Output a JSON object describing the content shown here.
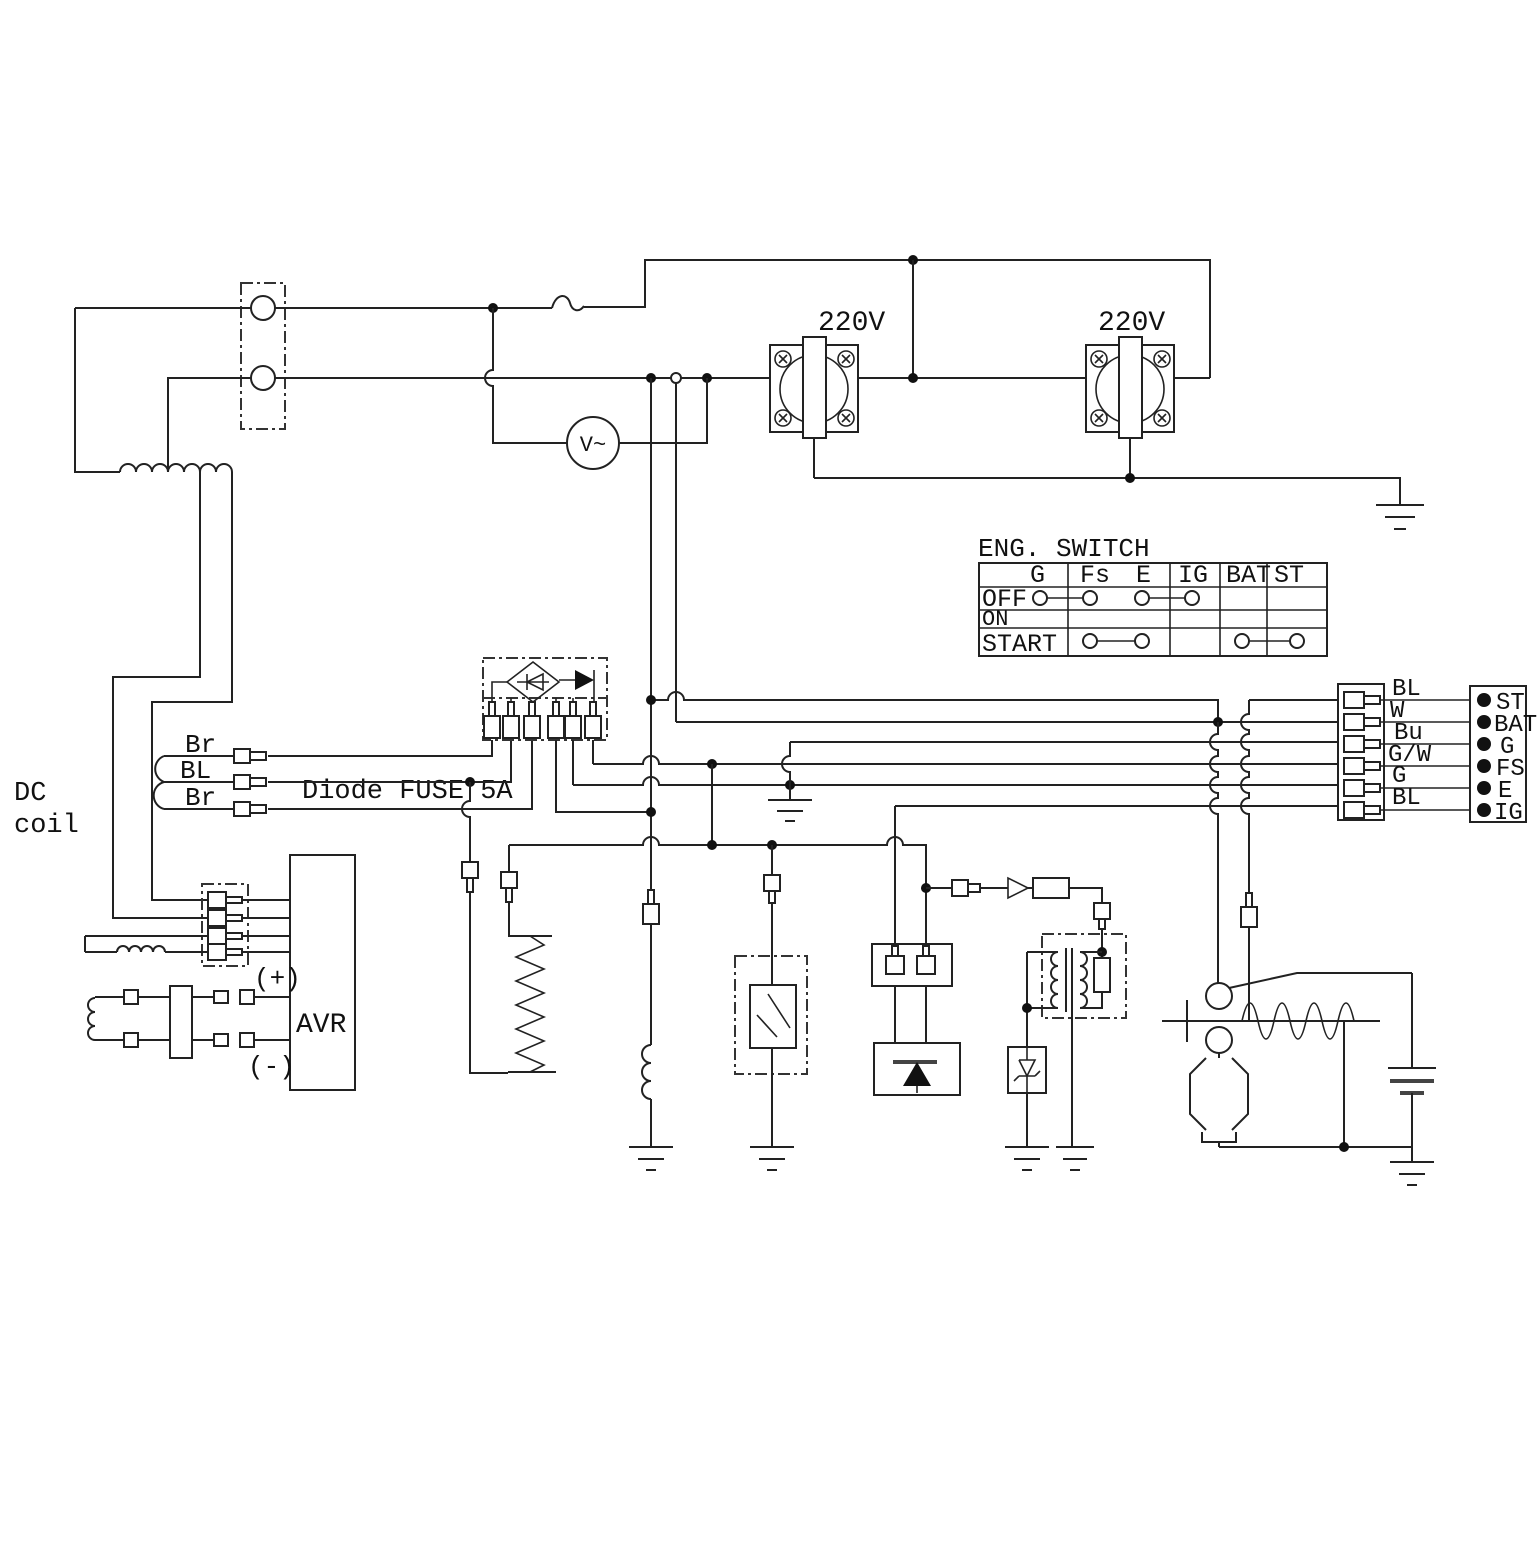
{
  "labels": {
    "outlet1": "220V",
    "outlet2": "220V",
    "voltmeter": "V~",
    "dc_coil_1": "DC",
    "dc_coil_2": "coil",
    "diode_fuse": "Diode FUSE 5A",
    "avr": "AVR",
    "avr_plus": "(+)",
    "avr_minus": "(-)",
    "stator_wire_1": "Br",
    "stator_wire_2": "BL",
    "stator_wire_3": "Br"
  },
  "eng_switch": {
    "title": "ENG. SWITCH",
    "columns": [
      "G",
      "Fs",
      "E",
      "IG",
      "BAT",
      "ST"
    ],
    "rows": [
      "OFF",
      "ON",
      "START"
    ]
  },
  "harness": {
    "wire_labels": [
      "BL",
      "W",
      "Bu",
      "G/W",
      "G",
      "BL"
    ],
    "terminal_labels": [
      "ST",
      "BAT",
      "G",
      "FS",
      "E",
      "IG"
    ]
  }
}
